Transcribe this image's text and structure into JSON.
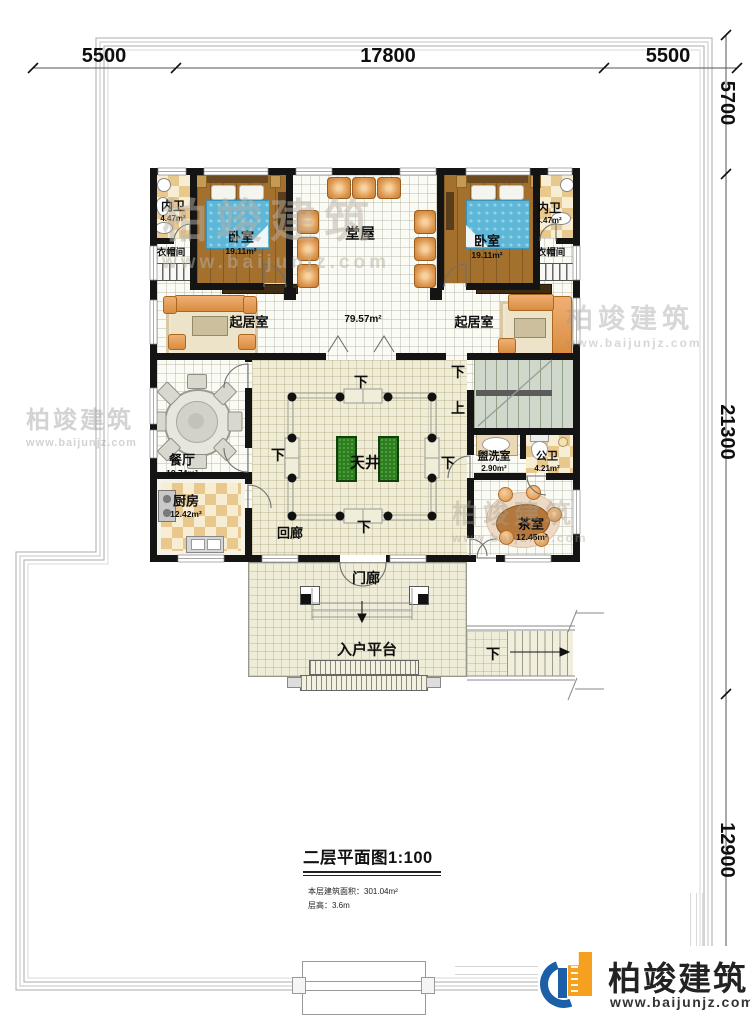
{
  "dimensions": {
    "top": [
      "5500",
      "17800",
      "5500"
    ],
    "right": [
      "5700",
      "21300",
      "12900"
    ]
  },
  "rooms": {
    "bath_left": {
      "name": "内卫",
      "area": "4.47m²"
    },
    "bedroom_left": {
      "name": "卧室",
      "area": "19.11m²"
    },
    "cloak_left": {
      "name": "衣帽间"
    },
    "hall": {
      "name": "堂屋"
    },
    "bedroom_right": {
      "name": "卧室",
      "area": "19.11m²"
    },
    "bath_right": {
      "name": "内卫",
      "area": "4.47m²"
    },
    "cloak_right": {
      "name": "衣帽间"
    },
    "living_left": {
      "name": "起居室"
    },
    "living_right": {
      "name": "起居室"
    },
    "open_area": {
      "area": "79.57m²"
    },
    "dining": {
      "name": "餐厅",
      "area": "19.74m²"
    },
    "courtyard": {
      "name": "天井"
    },
    "kitchen": {
      "name": "厨房",
      "area": "12.42m²"
    },
    "corridor": {
      "name": "回廊"
    },
    "washroom": {
      "name": "盥洗室",
      "area": "2.90m²"
    },
    "toilet": {
      "name": "公卫",
      "area": "4.21m²"
    },
    "tearoom": {
      "name": "茶室",
      "area": "12.45m²"
    },
    "porch": {
      "name": "门廊"
    },
    "platform": {
      "name": "入户平台"
    }
  },
  "stairs": {
    "down": "下",
    "up": "上"
  },
  "title_block": {
    "title": "二层平面图1:100",
    "area_line": "本层建筑面积：301.04m²",
    "height_line": "层高：3.6m"
  },
  "logo": {
    "brand": "柏竣建筑",
    "site": "www.baijunjz.com"
  },
  "watermark": {
    "brand": "柏竣建筑",
    "site": "www.baijunjz.com"
  },
  "colors": {
    "accent_blue": "#1a5fa8",
    "accent_orange": "#f5a01e"
  }
}
